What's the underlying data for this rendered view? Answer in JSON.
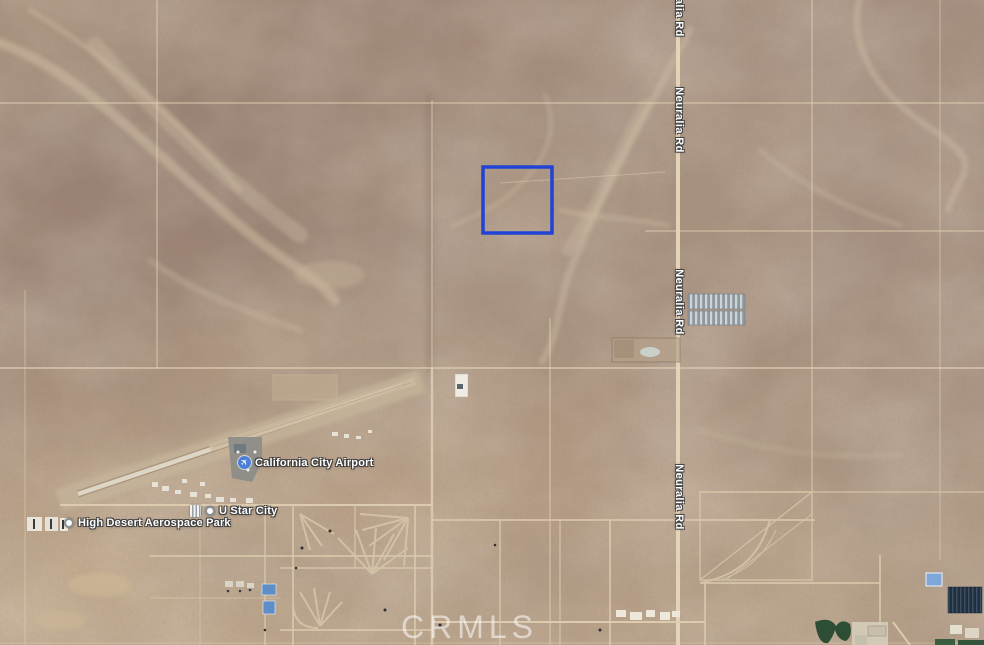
{
  "map": {
    "watermark": "CRMLS",
    "road_labels": [
      {
        "text": "Neuralia Rd"
      },
      {
        "text": "Neuralia Rd"
      },
      {
        "text": "Neuralia Rd"
      },
      {
        "text": "Neuralia Rd"
      }
    ],
    "places": [
      {
        "name": "California City Airport",
        "icon": "airport",
        "icon_glyph": "✈"
      },
      {
        "name": "U Star City",
        "icon": "place-dot"
      },
      {
        "name": "High Desert Aerospace Park",
        "icon": "place-dot"
      }
    ],
    "parcel": {
      "outline_color": "#2043d6"
    }
  }
}
